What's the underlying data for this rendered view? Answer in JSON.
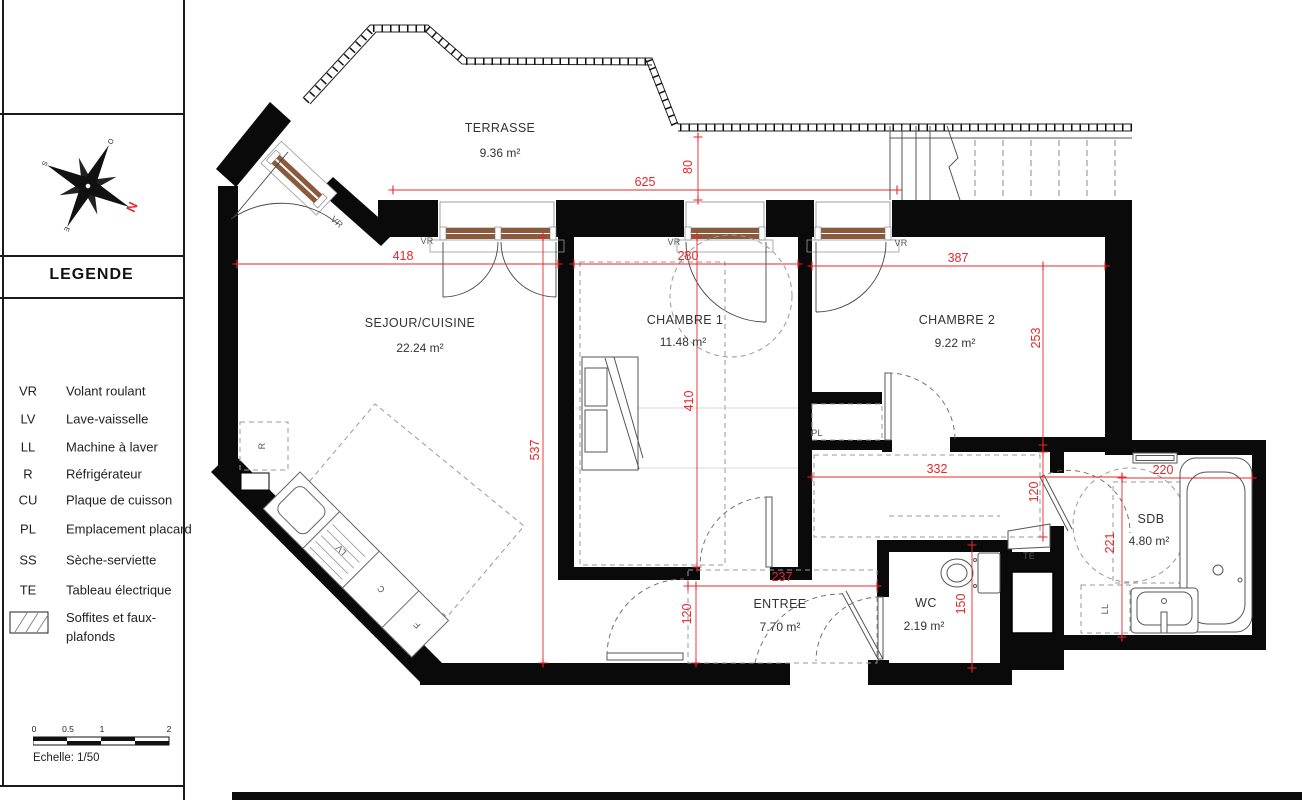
{
  "panel": {
    "legend_title": "LEGENDE",
    "items": [
      {
        "code": "VR",
        "label": "Volant roulant"
      },
      {
        "code": "LV",
        "label": "Lave-vaisselle"
      },
      {
        "code": "LL",
        "label": "Machine à laver"
      },
      {
        "code": "R",
        "label": "Réfrigérateur"
      },
      {
        "code": "CU",
        "label": "Plaque de cuisson"
      },
      {
        "code": "PL",
        "label": "Emplacement placard"
      },
      {
        "code": "SS",
        "label": "Sèche-serviette"
      },
      {
        "code": "TE",
        "label": "Tableau électrique"
      },
      {
        "code": "",
        "label": "Soffites et faux-",
        "label2": "plafonds"
      }
    ],
    "scale": {
      "ticks": [
        "0",
        "0.5",
        "1",
        "2"
      ],
      "caption": "Echelle: 1/50"
    },
    "compass": {
      "north": "N",
      "south": "S",
      "east": "E",
      "west": "O"
    }
  },
  "plan": {
    "rooms": [
      {
        "name": "TERRASSE",
        "area": "9.36 m²"
      },
      {
        "name": "SEJOUR/CUISINE",
        "area": "22.24 m²"
      },
      {
        "name": "CHAMBRE 1",
        "area": "11.48 m²"
      },
      {
        "name": "CHAMBRE 2",
        "area": "9.22 m²"
      },
      {
        "name": "ENTREE",
        "area": "7.70 m²"
      },
      {
        "name": "WC",
        "area": "2.19 m²"
      },
      {
        "name": "SDB",
        "area": "4.80 m²"
      }
    ],
    "dimensions": {
      "terrace_width": "625",
      "terrace_gap": "80",
      "sejour_width": "418",
      "chambre1_width": "280",
      "chambre2_width": "387",
      "sejour_height": "537",
      "chambre1_height": "410",
      "chambre2_height": "253",
      "corridor_width": "332",
      "sdb_width": "220",
      "sdb_height": "221",
      "sdb_door": "120",
      "entree_width": "237",
      "entree_door": "120",
      "wc_height": "150"
    },
    "tags": {
      "vr": "VR",
      "r": "R",
      "lv": "LV",
      "cu": "C",
      "four": "F",
      "pl": "PL",
      "te": "TE",
      "ll": "LL"
    },
    "colors": {
      "dimension_red": "#e8262a",
      "window_brown": "#8a5a3c",
      "wall_black": "#0a0a0a"
    }
  }
}
